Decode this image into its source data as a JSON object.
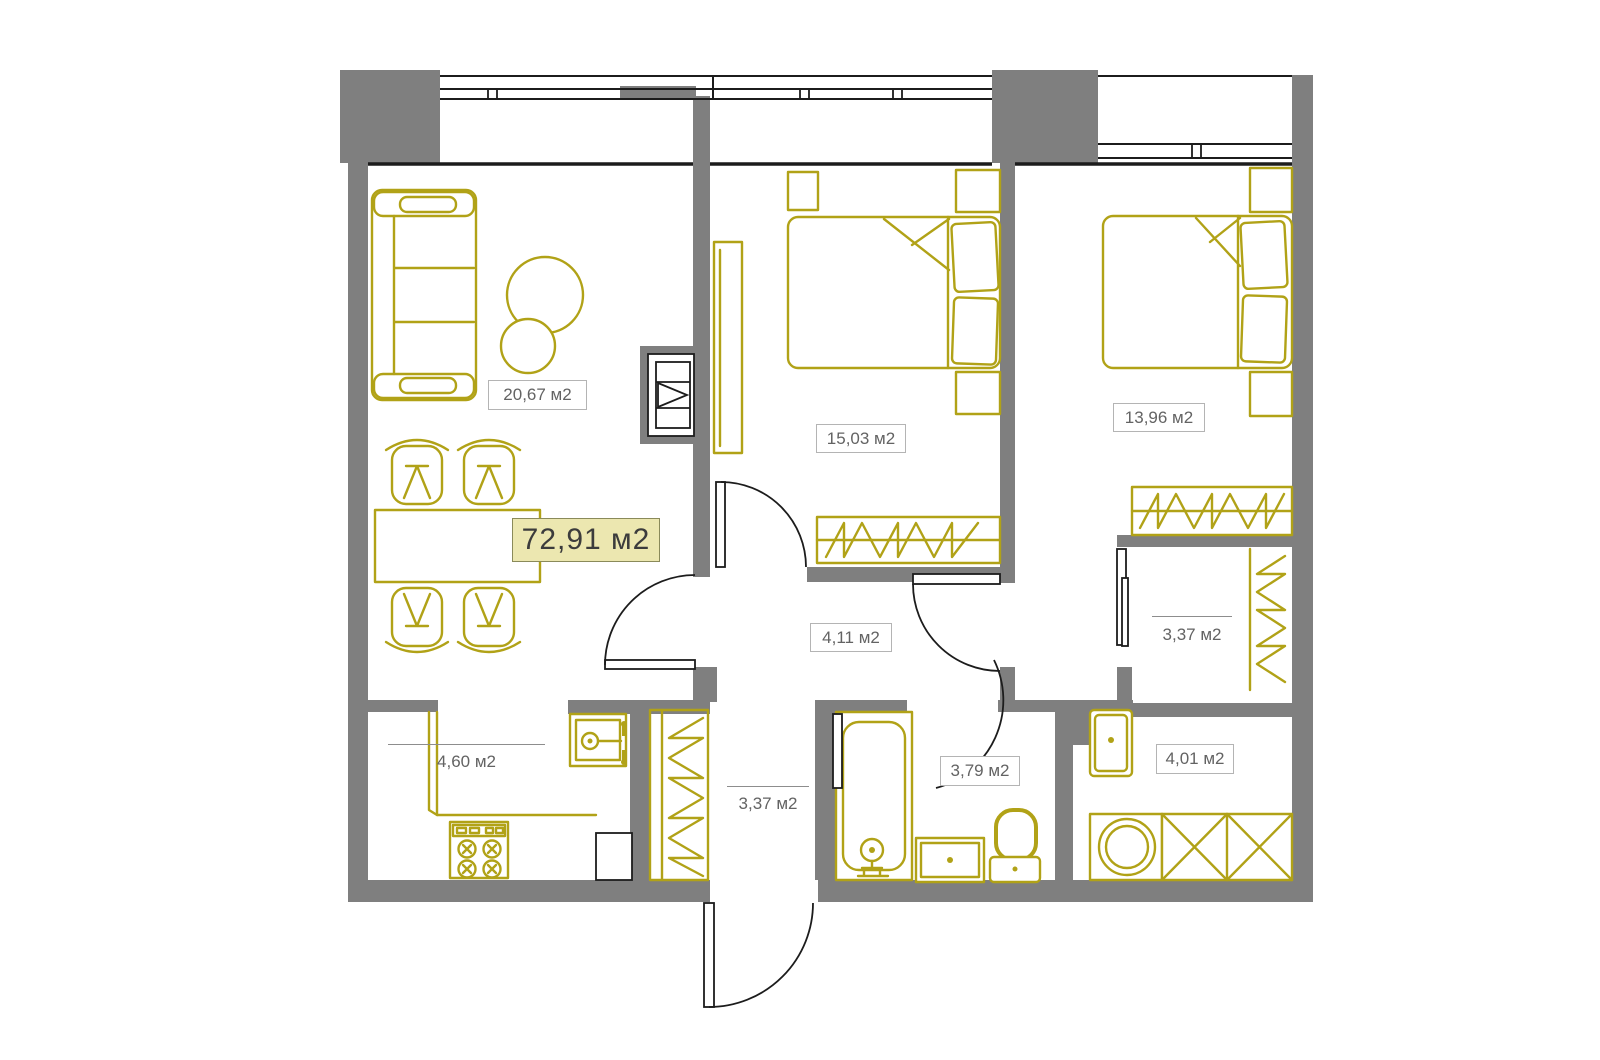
{
  "theme": {
    "wall": "#7f7f7f",
    "furniture": "#b1a217",
    "line": "#1c1c1c",
    "label_text": "#636363",
    "label_border": "#b4b4b4",
    "label_bg": "#ffffff",
    "badge_bg": "#ece7b0",
    "badge_border": "#8a8a5a",
    "badge_text": "#3c3c3c",
    "floor": "#ffffff"
  },
  "plan": {
    "total_area_label": "72,91 м2",
    "rooms": [
      {
        "name": "living-room",
        "area_label": "20,67 м2"
      },
      {
        "name": "bedroom-1",
        "area_label": "15,03 м2"
      },
      {
        "name": "bedroom-2",
        "area_label": "13,96 м2"
      },
      {
        "name": "hall",
        "area_label": "4,11 м2"
      },
      {
        "name": "closet-hall",
        "area_label": "3,37 м2"
      },
      {
        "name": "kitchen",
        "area_label": "4,60 м2"
      },
      {
        "name": "entry-hall",
        "area_label": "3,37 м2"
      },
      {
        "name": "bathroom",
        "area_label": "3,79 м2"
      },
      {
        "name": "laundry",
        "area_label": "4,01 м2"
      }
    ]
  }
}
